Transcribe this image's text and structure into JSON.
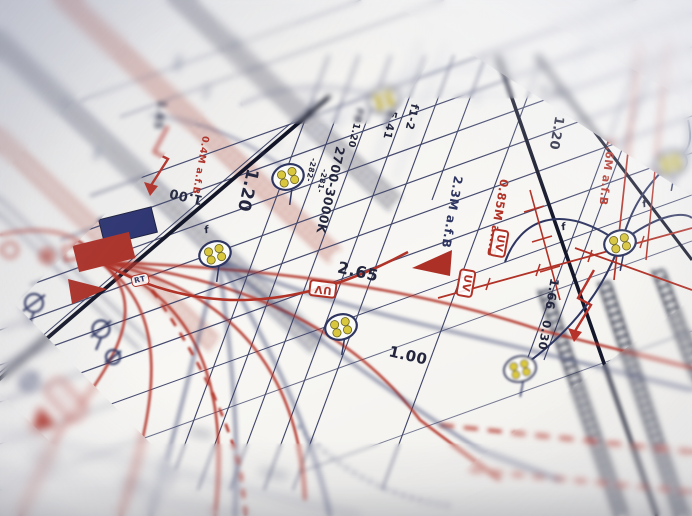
{
  "annotations": {
    "dim_120_center": "1.20",
    "color_temp": "2700-3000K",
    "dim_265": "2.65",
    "ref_fb120": "FB1.20",
    "dim_541": "5.41",
    "ref_f1_2": "f1-2",
    "wire_282": "-282-",
    "wire_281": "-281-",
    "mount_23m": "2.3M a.f.B",
    "mount_085m": "0.85M a.f.B",
    "mount_16m": "1.6M a.f.B",
    "dim_120_right": "1.20",
    "dim_348": "3.48",
    "dim_100_left": "1.00",
    "dim_100_bottom": "1.00",
    "dim_166": "1.66",
    "dim_030": "0.30",
    "dim_165": "1.65",
    "mount_04m": "0.4M a.f.B",
    "label_uv": "UV",
    "label_rt": "RT",
    "label_f": "f"
  },
  "symbols": {
    "cable_section": "cable-section-icon",
    "lightning": "lightning-arrow-icon",
    "no_entry": "circle-slash-icon",
    "uv_badge": "uv-fixture-badge",
    "junction_blue": "blue-junction-box",
    "junction_red": "red-junction-box"
  },
  "colors": {
    "paper": "#f4f3f1",
    "ink_navy": "#2e3560",
    "ink_black": "#14172a",
    "red": "#b13227",
    "blue_fill": "#2b3270",
    "yellow": "#d9c73e"
  }
}
